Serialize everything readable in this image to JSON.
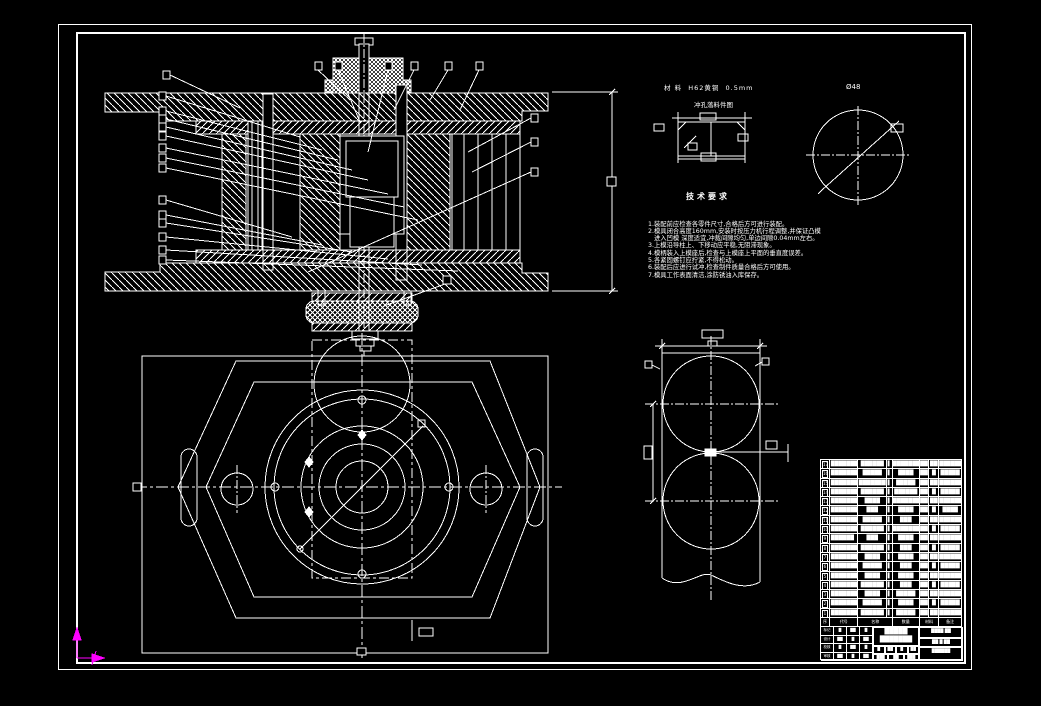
{
  "palette": {
    "background": "#000000",
    "line": "#ffffff",
    "ucs_axis": "#ff00ff"
  },
  "notes": {
    "heading": "技术要求",
    "lines": [
      {
        "t": "1.装配前应检查各零件尺寸,合格后方可进行装配。"
      },
      {
        "t": "2.模具闭合高度160mm,安装时按压力机行程调整,并保证凸模"
      },
      {
        "t": "   进入凹模 深度适宜,冲裁间隙均匀,单边间隙0.04mm左右。"
      },
      {
        "t": "3.上模沿导柱上、下移动应平稳,无阻滞现象。"
      },
      {
        "t": "4.模柄装入上模座后,检查与上模座上平面的垂直度误差。"
      },
      {
        "t": "5.各紧固螺钉应拧紧,不得松动。"
      },
      {
        "t": "6.装配后应进行试冲,检查制件质量合格后方可使用。"
      },
      {
        "t": "7.模具工作表面清洁,涂防锈油入库保存。"
      }
    ]
  },
  "detail_view": {
    "line1": "材 料  H62黄铜  0.5mm",
    "line2": "冲孔落料件图"
  },
  "circle_view": {
    "label": "Ø48"
  },
  "bom": {
    "header": [
      "序号",
      "代号",
      "名称",
      "数量",
      "材料",
      "备注"
    ],
    "rows": [
      {
        "no": "17",
        "c1": "█████████",
        "c2": "██████",
        "c3": "▌",
        "c4": "███████",
        "c5": "██",
        "c6": "██",
        "c7": "██████"
      },
      {
        "no": "16",
        "c1": "████████",
        "c2": "█████",
        "c3": "▌",
        "c4": "████",
        "c5": "██",
        "c6": "█",
        "c7": "█████"
      },
      {
        "no": "15",
        "c1": "█████████",
        "c2": "███████",
        "c3": "▌",
        "c4": "█████",
        "c5": "██",
        "c6": "██",
        "c7": "██████"
      },
      {
        "no": "14",
        "c1": "██████████",
        "c2": "██████",
        "c3": "▌",
        "c4": "██████",
        "c5": "██",
        "c6": "█",
        "c7": "█████"
      },
      {
        "no": "13",
        "c1": "███████",
        "c2": "████",
        "c3": "▌",
        "c4": "████████",
        "c5": "██",
        "c6": "██",
        "c7": "██████"
      },
      {
        "no": "12",
        "c1": "████████",
        "c2": "███",
        "c3": "▌",
        "c4": "████",
        "c5": "██",
        "c6": "█",
        "c7": "████"
      },
      {
        "no": "11",
        "c1": "█████████",
        "c2": "█████",
        "c3": "▌",
        "c4": "███",
        "c5": "██",
        "c6": "██",
        "c7": "██████"
      },
      {
        "no": "10",
        "c1": "██████████",
        "c2": "██████",
        "c3": "▌",
        "c4": "████████",
        "c5": "██",
        "c6": "█",
        "c7": "█████"
      },
      {
        "no": "9",
        "c1": "██████",
        "c2": "███",
        "c3": "▌",
        "c4": "████",
        "c5": "██",
        "c6": "██",
        "c7": "███████"
      },
      {
        "no": "8",
        "c1": "█████████",
        "c2": "██████",
        "c3": "▌",
        "c4": "███",
        "c5": "██",
        "c6": "█",
        "c7": "█████"
      },
      {
        "no": "7",
        "c1": "████████",
        "c2": "████",
        "c3": "▌",
        "c4": "████",
        "c5": "██",
        "c6": "██",
        "c7": "██████"
      },
      {
        "no": "6",
        "c1": "██████████",
        "c2": "█████",
        "c3": "▌",
        "c4": "███",
        "c5": "██",
        "c6": "█",
        "c7": "█████"
      },
      {
        "no": "5",
        "c1": "████████",
        "c2": "████",
        "c3": "▌",
        "c4": "████",
        "c5": "██",
        "c6": "██",
        "c7": "██████"
      },
      {
        "no": "4",
        "c1": "█████████",
        "c2": "██████",
        "c3": "▌",
        "c4": "███",
        "c5": "██",
        "c6": "█",
        "c7": "█████"
      },
      {
        "no": "3",
        "c1": "███████",
        "c2": "████",
        "c3": "▌",
        "c4": "█████",
        "c5": "██",
        "c6": "██",
        "c7": "██████"
      },
      {
        "no": "2",
        "c1": "█████████",
        "c2": "█████",
        "c3": "▌",
        "c4": "████",
        "c5": "██",
        "c6": "█",
        "c7": "█████"
      },
      {
        "no": "1",
        "c1": "████████",
        "c2": "██████",
        "c3": "▌",
        "c4": "█████",
        "c5": "██",
        "c6": "██",
        "c7": "██████"
      }
    ]
  },
  "titleblock": {
    "left_rows": [
      {
        "d0": "标记",
        "d1": "█",
        "d2": "██",
        "d3": "█"
      },
      {
        "d0": "设计",
        "d1": "██",
        "d2": "█",
        "d3": "██"
      },
      {
        "d0": "校核",
        "d1": "█",
        "d2": "██",
        "d3": "█"
      },
      {
        "d0": "审核",
        "d1": "██",
        "d2": "█",
        "d3": "██"
      }
    ],
    "title_line1": "█████",
    "title_line2": "███████",
    "sub1": [
      "█",
      "██",
      "█",
      "██"
    ],
    "sub2": [
      "███",
      "██",
      "███"
    ],
    "right_r0": "████ ██",
    "right_r1": "██ █ ██",
    "right_r2": "██████"
  }
}
